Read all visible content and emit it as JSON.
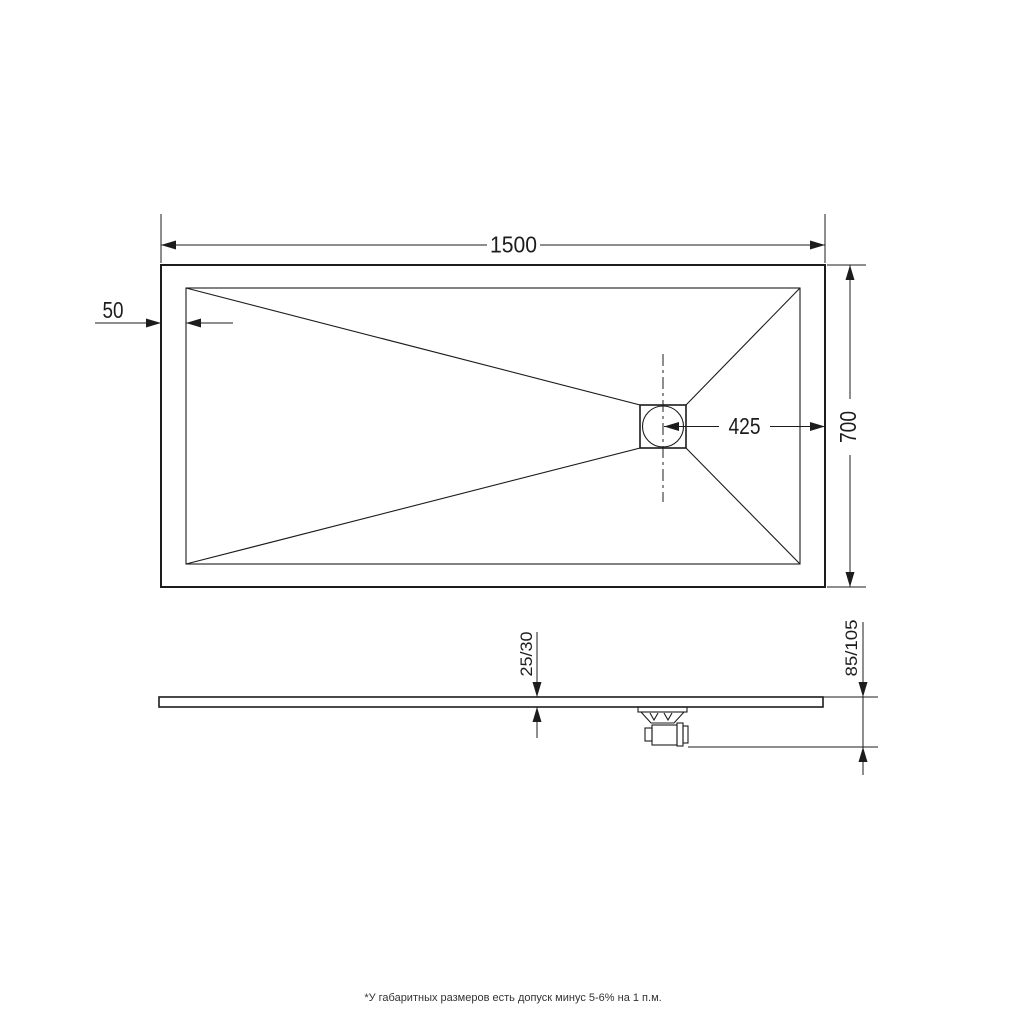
{
  "top_view": {
    "dim_length": "1500",
    "dim_width": "700",
    "dim_border": "50",
    "dim_drain_offset": "425"
  },
  "side_view": {
    "dim_thickness": "25/30",
    "dim_total_height": "85/105"
  },
  "footnote": "*У габаритных размеров есть допуск минус 5-6% на 1 п.м.",
  "colors": {
    "line": "#1c1c1c",
    "background": "#ffffff"
  }
}
